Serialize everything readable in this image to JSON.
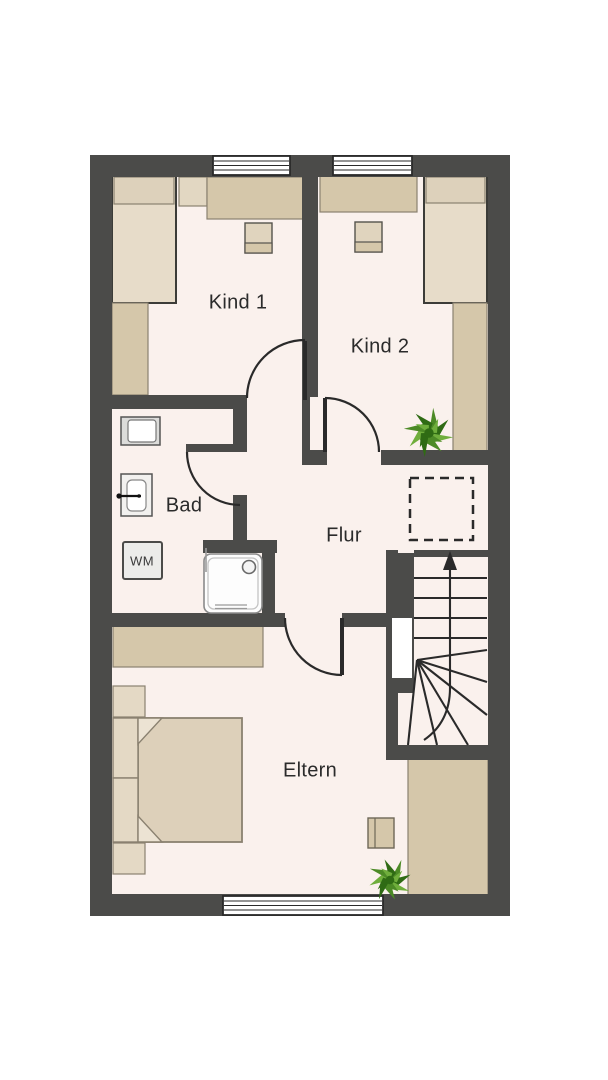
{
  "plan": {
    "title": "Obergeschoss Grundriss",
    "rooms": {
      "kind1": {
        "label": "Kind 1"
      },
      "kind2": {
        "label": "Kind 2"
      },
      "bad": {
        "label": "Bad"
      },
      "flur": {
        "label": "Flur"
      },
      "eltern": {
        "label": "Eltern"
      }
    },
    "appliances": {
      "washing_machine": "WM"
    },
    "icons": {
      "plant_top": "potted-plant",
      "plant_bottom": "potted-plant",
      "stairs_direction": "up-arrow",
      "ceiling_opening": "dashed-void-outline",
      "shower": "shower-tray",
      "toilet": "toilet",
      "sink": "wash-basin"
    }
  },
  "colors": {
    "wall": "#4b4b49",
    "floor": "#faf1ed",
    "ink": "#2b2b2b",
    "line": "#2a2a2a",
    "furn": "#d5c7aa",
    "furn_light": "#e7dcc9",
    "furn_pale": "#ddd1bb",
    "furn_edge": "#8a8170",
    "bed_edge": "#3c3c38",
    "plant_dark": "#2f6b14",
    "plant_mid": "#4c8a26",
    "plant_light": "#6fae3c",
    "fixture_edge": "#555555",
    "white": "#ffffff"
  }
}
